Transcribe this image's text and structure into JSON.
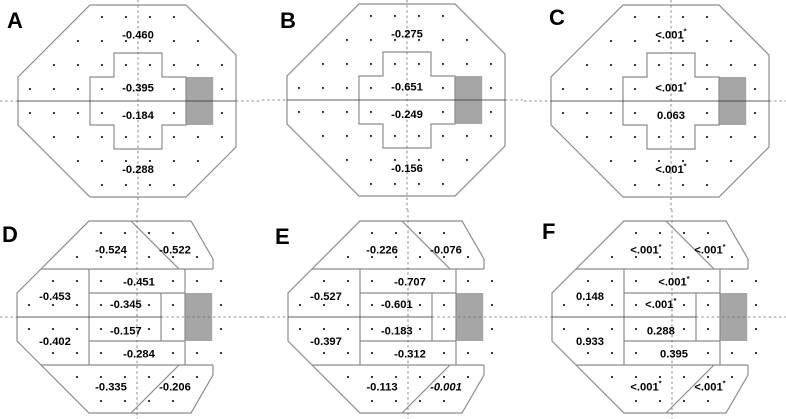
{
  "style": {
    "background": "#ffffff",
    "outline_color": "#8c8c8c",
    "solid_midline_color": "#2b2b2b",
    "dashed_line_color": "#6a6a6a",
    "dot_color": "#1f1f1f",
    "blindspot_fill": "#a6a6a6",
    "value_text_color": "#000000"
  },
  "chart_data": {
    "type": "table",
    "title": "",
    "description": "Six 24-2 visual-field maps (panels A-F). Dotted grid = test points, gray square = blind spot, dashed crosshair = horizontal/vertical meridians. Panels A-C: 4 regions around a central cross. Panels D-F: 10 sectors.",
    "panels": [
      {
        "letter": "A",
        "layout": "cross",
        "regions": [
          {
            "name": "superior",
            "value": "-0.460",
            "star": false,
            "italic": false
          },
          {
            "name": "central-superior",
            "value": "-0.395",
            "star": false,
            "italic": false
          },
          {
            "name": "central-inferior",
            "value": "-0.184",
            "star": false,
            "italic": false
          },
          {
            "name": "inferior",
            "value": "-0.288",
            "star": false,
            "italic": false
          }
        ]
      },
      {
        "letter": "B",
        "layout": "cross",
        "regions": [
          {
            "name": "superior",
            "value": "-0.275",
            "star": false,
            "italic": false
          },
          {
            "name": "central-superior",
            "value": "-0.651",
            "star": false,
            "italic": false
          },
          {
            "name": "central-inferior",
            "value": "-0.249",
            "star": false,
            "italic": false
          },
          {
            "name": "inferior",
            "value": "-0.156",
            "star": false,
            "italic": false
          }
        ]
      },
      {
        "letter": "C",
        "layout": "cross",
        "regions": [
          {
            "name": "superior",
            "value": "<.001",
            "star": true,
            "italic": false
          },
          {
            "name": "central-superior",
            "value": "<.001",
            "star": true,
            "italic": false
          },
          {
            "name": "central-inferior",
            "value": "0.063",
            "star": false,
            "italic": false
          },
          {
            "name": "inferior",
            "value": "<.001",
            "star": true,
            "italic": false
          }
        ]
      },
      {
        "letter": "D",
        "layout": "sectors",
        "regions": [
          {
            "name": "superior-left",
            "value": "-0.524",
            "star": false,
            "italic": false
          },
          {
            "name": "superior-right",
            "value": "-0.522",
            "star": false,
            "italic": false
          },
          {
            "name": "superior-arcuate",
            "value": "-0.451",
            "star": false,
            "italic": false
          },
          {
            "name": "superior-nasal",
            "value": "-0.453",
            "star": false,
            "italic": false
          },
          {
            "name": "central-superior",
            "value": "-0.345",
            "star": false,
            "italic": false
          },
          {
            "name": "central-inferior",
            "value": "-0.157",
            "star": false,
            "italic": false
          },
          {
            "name": "inferior-nasal",
            "value": "-0.402",
            "star": false,
            "italic": false
          },
          {
            "name": "inferior-arcuate",
            "value": "-0.284",
            "star": false,
            "italic": false
          },
          {
            "name": "inferior-left",
            "value": "-0.335",
            "star": false,
            "italic": false
          },
          {
            "name": "inferior-right",
            "value": "-0.206",
            "star": false,
            "italic": false
          }
        ]
      },
      {
        "letter": "E",
        "layout": "sectors",
        "regions": [
          {
            "name": "superior-left",
            "value": "-0.226",
            "star": false,
            "italic": false
          },
          {
            "name": "superior-right",
            "value": "-0.076",
            "star": false,
            "italic": false
          },
          {
            "name": "superior-arcuate",
            "value": "-0.707",
            "star": false,
            "italic": false
          },
          {
            "name": "superior-nasal",
            "value": "-0.527",
            "star": false,
            "italic": false
          },
          {
            "name": "central-superior",
            "value": "-0.601",
            "star": false,
            "italic": false
          },
          {
            "name": "central-inferior",
            "value": "-0.183",
            "star": false,
            "italic": false
          },
          {
            "name": "inferior-nasal",
            "value": "-0.397",
            "star": false,
            "italic": false
          },
          {
            "name": "inferior-arcuate",
            "value": "-0.312",
            "star": false,
            "italic": false
          },
          {
            "name": "inferior-left",
            "value": "-0.113",
            "star": false,
            "italic": false
          },
          {
            "name": "inferior-right",
            "value": "-0.001",
            "star": false,
            "italic": true
          }
        ]
      },
      {
        "letter": "F",
        "layout": "sectors",
        "regions": [
          {
            "name": "superior-left",
            "value": "<.001",
            "star": true,
            "italic": false
          },
          {
            "name": "superior-right",
            "value": "<.001",
            "star": true,
            "italic": false
          },
          {
            "name": "superior-arcuate",
            "value": "<.001",
            "star": true,
            "italic": false
          },
          {
            "name": "superior-nasal",
            "value": "0.148",
            "star": false,
            "italic": false
          },
          {
            "name": "central-superior",
            "value": "<.001",
            "star": true,
            "italic": false
          },
          {
            "name": "central-inferior",
            "value": "0.288",
            "star": false,
            "italic": false
          },
          {
            "name": "inferior-nasal",
            "value": "0.933",
            "star": false,
            "italic": false
          },
          {
            "name": "inferior-arcuate",
            "value": "0.395",
            "star": false,
            "italic": false
          },
          {
            "name": "inferior-left",
            "value": "<.001",
            "star": true,
            "italic": false
          },
          {
            "name": "inferior-right",
            "value": "<.001",
            "star": true,
            "italic": false
          }
        ]
      }
    ]
  }
}
